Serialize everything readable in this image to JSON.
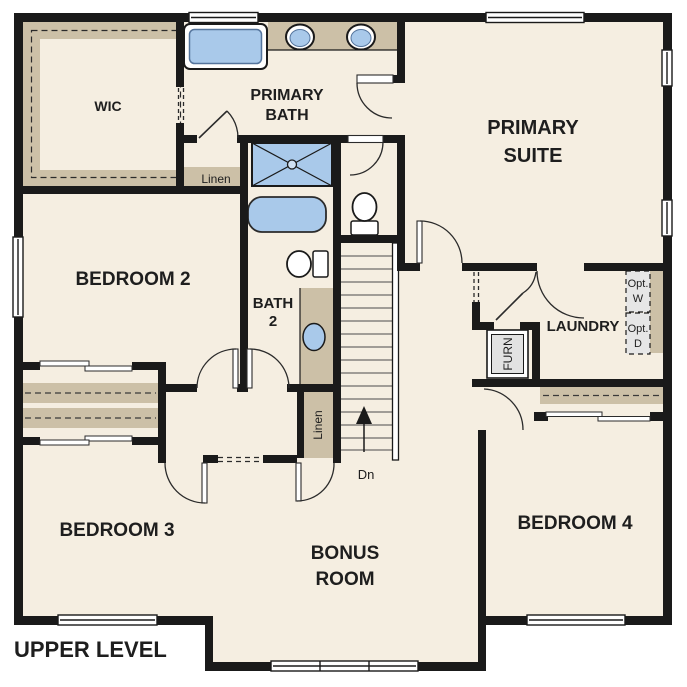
{
  "plan": {
    "title": "UPPER LEVEL",
    "rooms": {
      "wic": "WIC",
      "primary_bath": [
        "PRIMARY",
        "BATH"
      ],
      "primary_suite": [
        "PRIMARY",
        "SUITE"
      ],
      "bedroom2": "BEDROOM 2",
      "bath2": [
        "BATH",
        "2"
      ],
      "laundry": "LAUNDRY",
      "bedroom3": "BEDROOM 3",
      "bonus": [
        "BONUS",
        "ROOM"
      ],
      "bedroom4": "BEDROOM 4"
    },
    "features": {
      "linen_upper": "Linen",
      "linen_hall": "Linen",
      "furnace": "FURN",
      "stair_direction": "Dn",
      "opt_washer": [
        "Opt.",
        "W"
      ],
      "opt_dryer": [
        "Opt.",
        "D"
      ]
    },
    "colors": {
      "floor": "#f5eee1",
      "cabinet": "#ccc0a7",
      "fixture_fill": "#a9c9ea",
      "fixture_stroke": "#54749c",
      "wall": "#1a1a1a",
      "opt_box": "#e6e6e6"
    }
  }
}
